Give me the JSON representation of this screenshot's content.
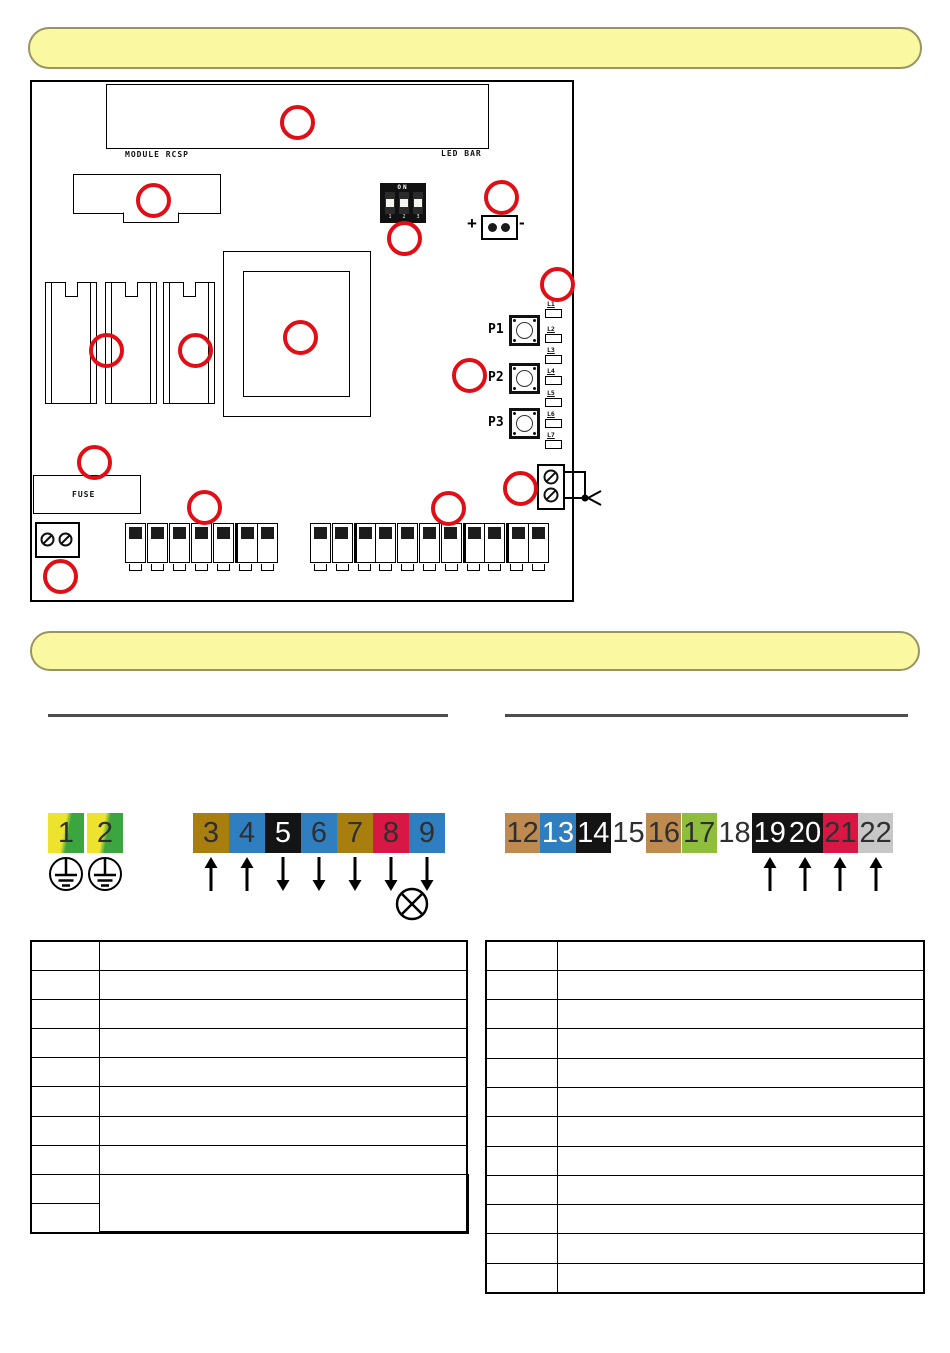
{
  "banners": {
    "top": {
      "text": ""
    },
    "middle": {
      "text": ""
    }
  },
  "board": {
    "labels": {
      "module_rcsp": "MODULE RCSP",
      "led_bar": "LED BAR",
      "dip_on": "ON",
      "dip_numbers": [
        "1",
        "2",
        "3"
      ],
      "jumper_plus": "+",
      "jumper_minus": "-",
      "buttons": [
        "P1",
        "P2",
        "P3"
      ],
      "leds": [
        "L1",
        "L2",
        "L3",
        "L4",
        "L5",
        "L6",
        "L7"
      ],
      "fuse": "FUSE"
    },
    "terminals": {
      "left_count": 7,
      "right_count": 11
    }
  },
  "wiring": {
    "earth_cells": [
      {
        "label": "1"
      },
      {
        "label": "2"
      }
    ],
    "strip1": [
      {
        "label": "3",
        "bg": "#a87e0f",
        "fg": "#2f2f2f",
        "arrow": "up"
      },
      {
        "label": "4",
        "bg": "#2e7ec0",
        "fg": "#2f2f2f",
        "arrow": "up"
      },
      {
        "label": "5",
        "bg": "#141414",
        "fg": "#ffffff",
        "arrow": "down"
      },
      {
        "label": "6",
        "bg": "#2e7ec0",
        "fg": "#2f2f2f",
        "arrow": "down"
      },
      {
        "label": "7",
        "bg": "#a87e0f",
        "fg": "#2f2f2f",
        "arrow": "down"
      },
      {
        "label": "8",
        "bg": "#d81745",
        "fg": "#2f2f2f",
        "arrow": "down"
      },
      {
        "label": "9",
        "bg": "#2e7ec0",
        "fg": "#2f2f2f",
        "arrow": "down"
      }
    ],
    "strip2": [
      {
        "label": "12",
        "bg": "#be8a4f",
        "fg": "#2f2f2f"
      },
      {
        "label": "13",
        "bg": "#2e7ec0",
        "fg": "#ffffff"
      },
      {
        "label": "14",
        "bg": "#141414",
        "fg": "#ffffff"
      },
      {
        "label": "15",
        "bg": "transparent",
        "fg": "#2f2f2f"
      },
      {
        "label": "16",
        "bg": "#be8a4f",
        "fg": "#2f2f2f"
      },
      {
        "label": "17",
        "bg": "#8fbe3c",
        "fg": "#2f2f2f"
      },
      {
        "label": "18",
        "bg": "transparent",
        "fg": "#2f2f2f"
      },
      {
        "label": "19",
        "bg": "#141414",
        "fg": "#ffffff",
        "arrow": "up"
      },
      {
        "label": "20",
        "bg": "#141414",
        "fg": "#ffffff",
        "arrow": "up"
      },
      {
        "label": "21",
        "bg": "#d81745",
        "fg": "#2f2f2f",
        "arrow": "up"
      },
      {
        "label": "22",
        "bg": "#c7c7c7",
        "fg": "#2f2f2f",
        "arrow": "up"
      }
    ],
    "symbols": {
      "earth": "earth-ground-symbol",
      "lamp": "lamp-symbol"
    }
  },
  "tables": {
    "left": {
      "rows": 10,
      "merged_last_two_right": true
    },
    "right": {
      "rows": 12
    }
  },
  "colors": {
    "callout_red": "#e10e15",
    "banner_fill": "#fbf8a2",
    "banner_border": "#9a9464",
    "divider": "#4d4d4d"
  }
}
